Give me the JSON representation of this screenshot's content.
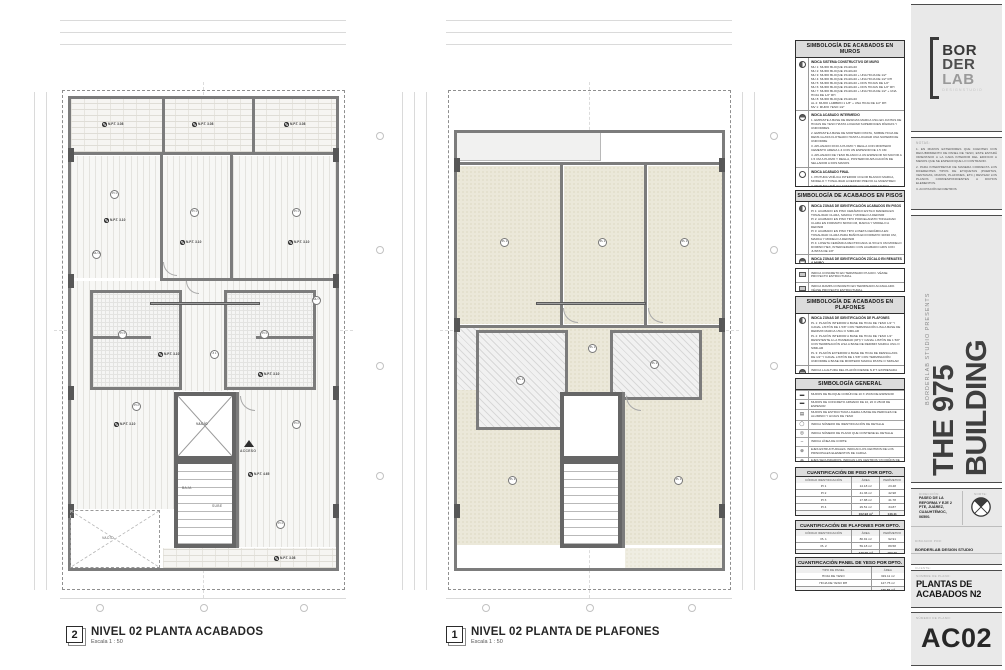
{
  "plans": [
    {
      "number": "2",
      "title": "NIVEL 02 PLANTA ACABADOS",
      "scale": "Escala 1 : 50"
    },
    {
      "number": "1",
      "title": "NIVEL 02 PLANTA DE PLAFONES",
      "scale": "Escala 1 : 50"
    }
  ],
  "plan_labels": {
    "npt_terrace": "N.P.T. 3.08",
    "npt_main": "N.P.T. 3.10",
    "npt_stair": "N.P.T. 4.65",
    "vacio": "VACÍO",
    "baja": "BAJA",
    "sube": "SUBE",
    "acceso": "ACCESO"
  },
  "tags": {
    "pi1": "PI 1",
    "pi2": "PI 2",
    "pi3": "PI 3",
    "pi4": "PI 4",
    "mu4": "MU 4",
    "mu7": "MU 7",
    "z1": "Z 1",
    "pl1": "PL 1",
    "pl2": "PL 2",
    "pl3": "PL 3"
  },
  "legends": {
    "muros": {
      "title": "SIMBOLOGÍA DE ACABADOS EN MUROS",
      "row1_heading": "INDICA SISTEMA CONSTRUCTIVO DE MURO",
      "codes": [
        "MU 1: MURO BLOQUE 15x20x40",
        "MU 2: MURO BLOQUE 15x20x40",
        "MU 3: MURO BLOQUE 15x20x40 + UNA HOJA DE 1/2\"",
        "MU 4: MURO BLOQUE 15x20x40 + UNA HOJA DE 1/2\" RH",
        "MU 5: MURO BLOQUE 15x20x40 + DOS HOJAS DE 1/2\"",
        "MU 6: MURO BLOQUE 15x20x40 + DOS HOJAS DE 1/2\" RH",
        "MU 7: MURO BLOQUE 15x20x40 + UNA HOJA DE 1/2\" + UNA HOJA DE 1/2\" RH",
        "MU 8: MURO BLOQUE 15x20x40",
        "AL 2: MURO LAMBRIN 1 1/8\" + UNA HOJA DE 1/2\" RH",
        "MV 1: MURO YESO 1/2\""
      ],
      "row2_heading": "INDICA ACABADO INTERMEDIO",
      "intermedio": [
        "1. EMPASTE A BASE DE RESINAS MARCA USG EN JUNTAS DE HOJAS DE YESO HASTA LOGRAR SUPERFICIES RÍGIDAS Y UNIFORMES",
        "2. EMPASTE A BASE DE MORTERO PASTA, SOBRE HOJA DE DENS GLASS FLOTEADO HASTA LOGRAR UNA SUPERFICIE UNIFORME",
        "3. APLANADO FINO A PLOMO Y REGLA CON MORTERO CEMENTO ARENA 1:4 CON UN ESPESOR DE 1.5 CM",
        "4. APLANADO DE YESO BLANCO A UN ESPESOR NO MAYOR A 1.5 CM A PLOMO Y REGLA, POSTERIOR APLICACIÓN DE SELLADOR A DOS MANOS"
      ],
      "row3_heading": "INDICA ACABADO FINAL",
      "final": [
        "1. PINTURA VINÍLICA INTERIOR COLOR BLANCO MARCA, MODELO Y TONALIDAD A DEFINIR PREVIO AL MUESTREO",
        "2. PINTURA VINÍLICA EXTERIOR COLOR GRIS MARCA, MODELO Y TONALIDAD A DEFINIR PREVIO AL MUESTREO",
        "3. PINTURA VINÍLICA COLOR NEGRO MARCA, MODELO Y TONALIDAD A DEFINIR PREVIO AL MUESTREO",
        "4. PINTURA VINÍLICA COLOR GRIS MARCA, MODELO Y TONALIDAD A DEFINIR PREVIO AL MUESTREO"
      ]
    },
    "pisos": {
      "title": "SIMBOLOGÍA DE ACABADOS EN PISOS",
      "row1_heading": "INDICA ZONAS DE IDENTIFICACIÓN ACABADOS EN PISOS",
      "items": [
        "PI 1: ACABADO EN PISO CERÁMICO ESTILO MADERA EN TONALIDAD CLARA, MARCA Y MODELO A DEFINIR",
        "PI 2: ACABADO EN PISO TIPO PORCELANATO TONALIDAD CLARA EN FORMATO 60X60 CM, MARCA Y MODELO A DEFINIR",
        "PI 3: ACABADO EN PISO TIPO LOSETA CERÁMICA EN TONALIDAD CLARA PARA BAÑOS EN FORMATO 30X30 CM, MARCA Y MODELO A DEFINIR",
        "PI 4: LOSETA CERÁMICA RECTIFICADA 11.5X12.9 CM MODELO DOMINO HEX, INTERCERAMIC CON ACABADO GRIS CON JUNTAS DE 1/8\""
      ],
      "row2_heading": "INDICA ZONAS DE IDENTIFICACIÓN ZÓCALO EN REMATES A MURO",
      "zocalos": [
        "Z1: ZÓCALO CERÁMICO DE 10 CM, MARCA Y MODELO SIMILAR A PISO INSTALADO",
        "Z2: ZÓCALO DE MADERA MDF DE 10.5 CM, COLOR PREVIO AL MUESTREO",
        "N/A: SIN ZÓCALO. CONSULTAR RECUBRIMIENTO FINAL DE MUROS"
      ],
      "concrete": [
        "INDICA CONCRETO EN TERMINADO PULIDO. VÉASE PROYECTO ESTRUCTURAL",
        "INDICA RAMPA CONCRETO EN TERMINADO ACANALADO. VÉASE PROYECTO ESTRUCTURAL"
      ]
    },
    "plafones": {
      "title": "SIMBOLOGÍA DE ACABADOS EN PLAFONES",
      "row1_heading": "INDICA ZONAS DE IDENTIFICACIÓN DE PLAFONES",
      "items": [
        "PL 1: PLAFÓN INTERIOR A BASE DE HOJA DE YESO 1/2\" Y CANAL LISTÓN DE 1 5/8\" CON TERMINACIÓN LISA A BASE DE REDIMIX MARCA USG O SIMILAR",
        "PL 2: PLAFÓN INTERIOR A BASE DE HOJA DE YESO 1/2\" RESISTENTE A LA HUMEDAD (RH) Y CANAL LISTÓN DE 1 5/8\" CON TERMINACIÓN LISA A BASE DE REDIMIX MARCA USG O SIMILAR",
        "PL 3: PLAFÓN EXTERIOR A BASE DE HOJA DE DENSGLASS DE 1/2\" Y CANAL LISTÓN DE 1 5/8\" CON TERMINACIÓN UNIFORME A BASE DE MORTERO MARCA PASTE O SIMILAR"
      ],
      "row2_text": "INDICA LA ALTURA DEL PLAFÓN DESDE N.P.T. EXPRESADA EN METROS.",
      "row3_text": "INDICA CAMBIO DE ALTURA EN PLAFÓN"
    },
    "general": {
      "title": "SIMBOLOGÍA GENERAL",
      "rows": [
        {
          "glyph": "▬",
          "text": "MUROS DE BLOQUE COMÚN DE 10 X 15CM DE ESPESOR"
        },
        {
          "glyph": "▬",
          "text": "MUROS DE CONCRETO ARMADO DE 10, 20 O 25CM DE ESPESOR"
        },
        {
          "glyph": "▤",
          "text": "MUROS DE ESTRUCTURA LIGERA A BASE DE PERFILES DE ALUMINIO Y HOJAS DE YESO"
        },
        {
          "glyph": "◯",
          "text": "INDICA NÚMERO DE IDENTIFICACIÓN DE DETALLE"
        },
        {
          "glyph": "◎",
          "text": "INDICA NÚMERO DE PLANO QUE CONTIENE EL DETALLE"
        },
        {
          "glyph": "╌",
          "text": "INDICA LÍNEA DE CORTE"
        },
        {
          "glyph": "⊕",
          "text": "EJES ESTRUCTURALES. INDICAN LOS CENTROS DE LOS PRINCIPALES ELEMENTOS DE CARGA"
        },
        {
          "glyph": "⊕",
          "text": "EJES SECUNDARIOS. INDICAN LOS CENTROS Y/O PAÑOS DE LOS ELEMENTOS YA EXISTENTES EN EL PROYECTO"
        },
        {
          "glyph": "✛",
          "text": "INDICA NIVEL DE PISO TERMINADO"
        },
        {
          "glyph": "✛",
          "text": "INDICA NIVEL EN PUNTO ESPECÍFICO"
        }
      ]
    }
  },
  "tables": {
    "piso": {
      "title": "CUANTIFICACIÓN DE PISO POR DPTO.",
      "h1": "CÓDIGO IDENTIFICACIÓN",
      "h2": "ÁREA",
      "h3": "PERÍMETRO",
      "rows": [
        {
          "c": "PI 1",
          "a": "14.18 m²",
          "p": "23.48"
        },
        {
          "c": "PI 2",
          "a": "41.36 m²",
          "p": "42.98"
        },
        {
          "c": "PI 3",
          "a": "17.88 m²",
          "p": "41.78"
        },
        {
          "c": "PI 4",
          "a": "29.51 m²",
          "p": "34.87"
        }
      ],
      "total_area": "102.93 m²",
      "total_perim": "143.11"
    },
    "plafones": {
      "title": "CUANTIFICACIÓN DE PLAFONES POR DPTO.",
      "h1": "CÓDIGO IDENTIFICACIÓN",
      "h2": "ÁREA",
      "h3": "PERÍMETRO",
      "rows": [
        {
          "c": "PL 1",
          "a": "80.91 m²",
          "p": "92.91"
        },
        {
          "c": "PL 2",
          "a": "59.18 m²",
          "p": "89.58"
        }
      ],
      "total_area": "140.09 m²",
      "total_perim": "182.49"
    },
    "yeso": {
      "title": "CUANTIFICACIÓN PANEL DE YESO POR DPTO.",
      "h1": "TIPO DE PANEL",
      "h2": "ÁREA",
      "rows": [
        {
          "c": "HOJA DE YESO",
          "a": "319.11 m²"
        },
        {
          "c": "HOJA DE YESO RH",
          "a": "127.75 m²"
        }
      ],
      "total_area": "446.86 m²"
    }
  },
  "titleblock": {
    "logo": {
      "line1": "BOR",
      "line2": "DER",
      "line3": "LAB",
      "sub": "DESIGNSTUDIO"
    },
    "notes": {
      "label": "NOTAS:",
      "items": [
        "1. EN MUROS EXTERIORES QUE CUENTEN CON RECUBRIMIENTO DE PANEL DE YESO, ESTE ESTARÁ ORIENTADO A LA CARA INTERIOR DEL EDIFICIO A MENOS QUE SE ESPECIFIQUE LO CONTRARIO.",
        "2. PARA INTERPRETAR DE MANERA CORRECTA LOS DIFERENTES TIPOS DE ETIQUETAS (PUERTAS, VENTANAS, MUROS, PLAFONES, ETC.) REVISAR LOS PLANOS CORRESPONDIENTES A DICHOS ELEMENTOS.",
        "3. ACOTACIÓN EN METROS"
      ]
    },
    "presents": "BORDERLAB STUDIO PRESENTS",
    "building": "THE 975 BUILDING",
    "direccion_label": "DIRECCIÓN:",
    "direccion": "PASEO DE LA REFORMA Y EJE 2 PTE, JUÁREZ, CUAUHTÉMOC, 06500.",
    "norte_label": "NORTE:",
    "drawn_label": "DIBUJADO POR:",
    "drawn": "BORDERLAB DESIGN STUDIO",
    "client_label": "CLIENTE:",
    "client": "BORDERLAB DESING STUDIO",
    "date_label": "FECHA:",
    "date": "06/29/22",
    "scale_label": "ESCALA:",
    "scale": "COMO SE INDICA",
    "name_label": "NOMBRE DE PLANO:",
    "name": "PLANTAS DE ACABADOS N2",
    "number_label": "NÚMERO DE PLANO:",
    "number": "AC02"
  }
}
